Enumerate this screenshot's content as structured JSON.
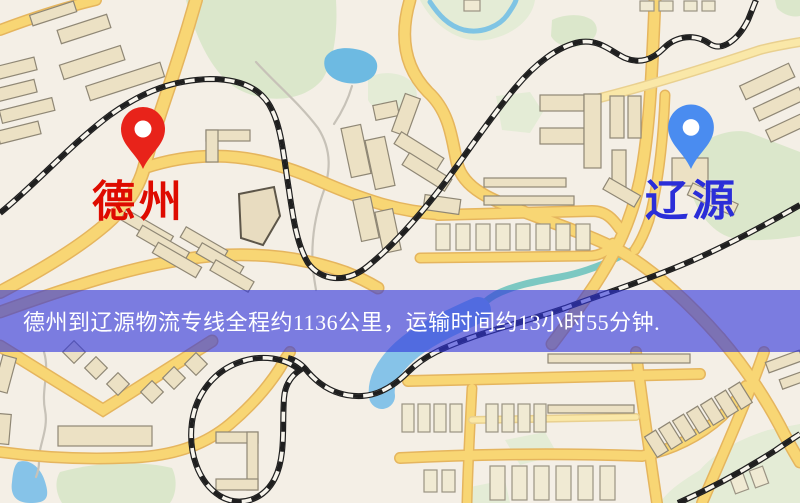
{
  "map": {
    "kind": "road-map",
    "markers": [
      {
        "id": "origin",
        "label": "德州",
        "icon": "red-location-pin-icon",
        "pin_color": "#e8231a",
        "label_color": "#de0b00"
      },
      {
        "id": "destination",
        "label": "辽源",
        "icon": "blue-location-pin-icon",
        "pin_color": "#4a8cf0",
        "label_color": "#2b2ed8"
      }
    ],
    "colors": {
      "background": "#f4efe6",
      "road_fill": "#f8d674",
      "road_casing": "#e5b55e",
      "minor_road_fill": "#fae8a8",
      "park": "#dbe7cb",
      "water": "#86c3e8",
      "lake": "#6dbae2",
      "stream": "#7cc8c2",
      "railway": "#1f1f1f",
      "building": "#ece1c4"
    }
  },
  "banner": {
    "text": "德州到辽源物流专线全程约1136公里，运输时间约13小时55分钟.",
    "background": "rgba(49,53,219,0.62)",
    "text_color": "#ffffff"
  }
}
